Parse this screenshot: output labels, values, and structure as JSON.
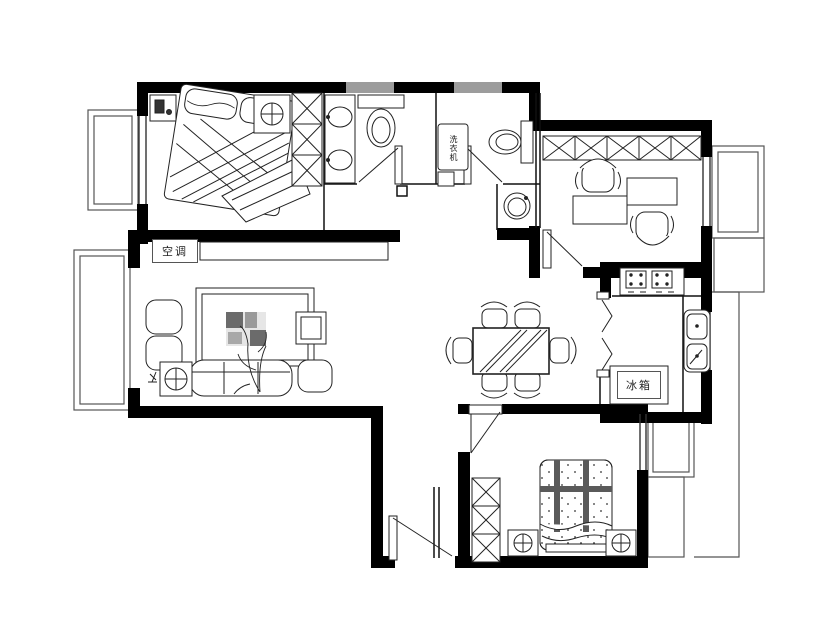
{
  "drawing": {
    "kind": "apartment-floor-plan",
    "labels": {
      "air_conditioner": "空调",
      "fridge": "冰箱",
      "washing_machine": "洗衣机"
    },
    "colors": {
      "background": "#ffffff",
      "wall": "#000000",
      "window_fill": "#9c9c9c",
      "line": "#222222",
      "accent_dark": "#555555"
    }
  }
}
